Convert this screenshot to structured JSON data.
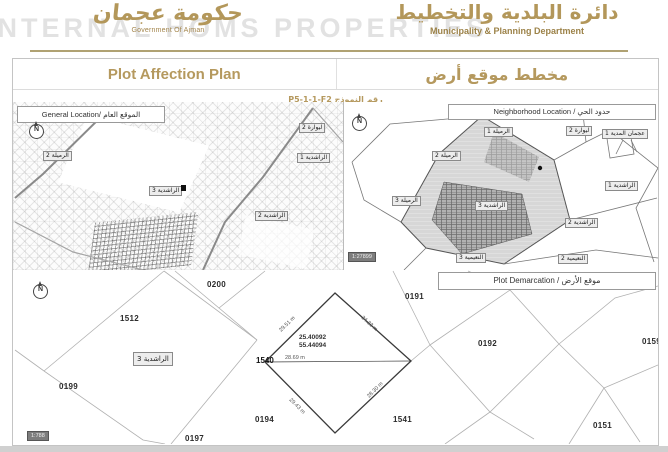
{
  "brand": {
    "accent": "#b3975a"
  },
  "header": {
    "watermark": "INTERNAL HOMS PROPERTIES",
    "left_logo_arabic": "حكومة عجمان",
    "left_logo_caption": "Government Of Ajman",
    "right_logo_arabic": "دائرة البلدية والتخطيط",
    "right_logo_caption": "Municipality & Planning Department"
  },
  "title": {
    "en": "Plot Affection Plan",
    "ar": "مخطط موقع أرض",
    "form": "رقم النموذج P5-1-1-F2"
  },
  "icons": {
    "compass": "N"
  },
  "general_map": {
    "header": "General Location/ الموقع العام",
    "labels": [
      "ليوارة 1",
      "الرميلة 2",
      "ليوارة 2",
      "الراشدية 1",
      "الراشدية 3",
      "الراشدية 2"
    ]
  },
  "neighborhood_map": {
    "header": "Neighborhood Location / حدود الحي",
    "scale": "1:27899",
    "labels": [
      "الرميلة 1",
      "ليوارة 2",
      "عجمان المدية 1",
      "الرميلة 2",
      "الرميلة 3",
      "الراشدية 3",
      "الراشدية 1",
      "الراشدية 2",
      "النعيمية 3",
      "النعيمية 2"
    ]
  },
  "plot_map": {
    "header": "Plot Demarcation / موقع الأرض",
    "scale": "1:788",
    "district": "الراشدية 3",
    "plot_number": "1540",
    "coordinates": [
      "25.40092",
      "55.44094"
    ],
    "dimensions": {
      "top_left": "29.51 m",
      "top_right": "34.33 m",
      "middle": "28.69 m",
      "bottom_left": "29.43 m",
      "bottom_right": "28.30 m"
    },
    "neighbors": [
      "0200",
      "0191",
      "1512",
      "0192",
      "0159",
      "0199",
      "0194",
      "1541",
      "0151",
      "0197"
    ]
  }
}
